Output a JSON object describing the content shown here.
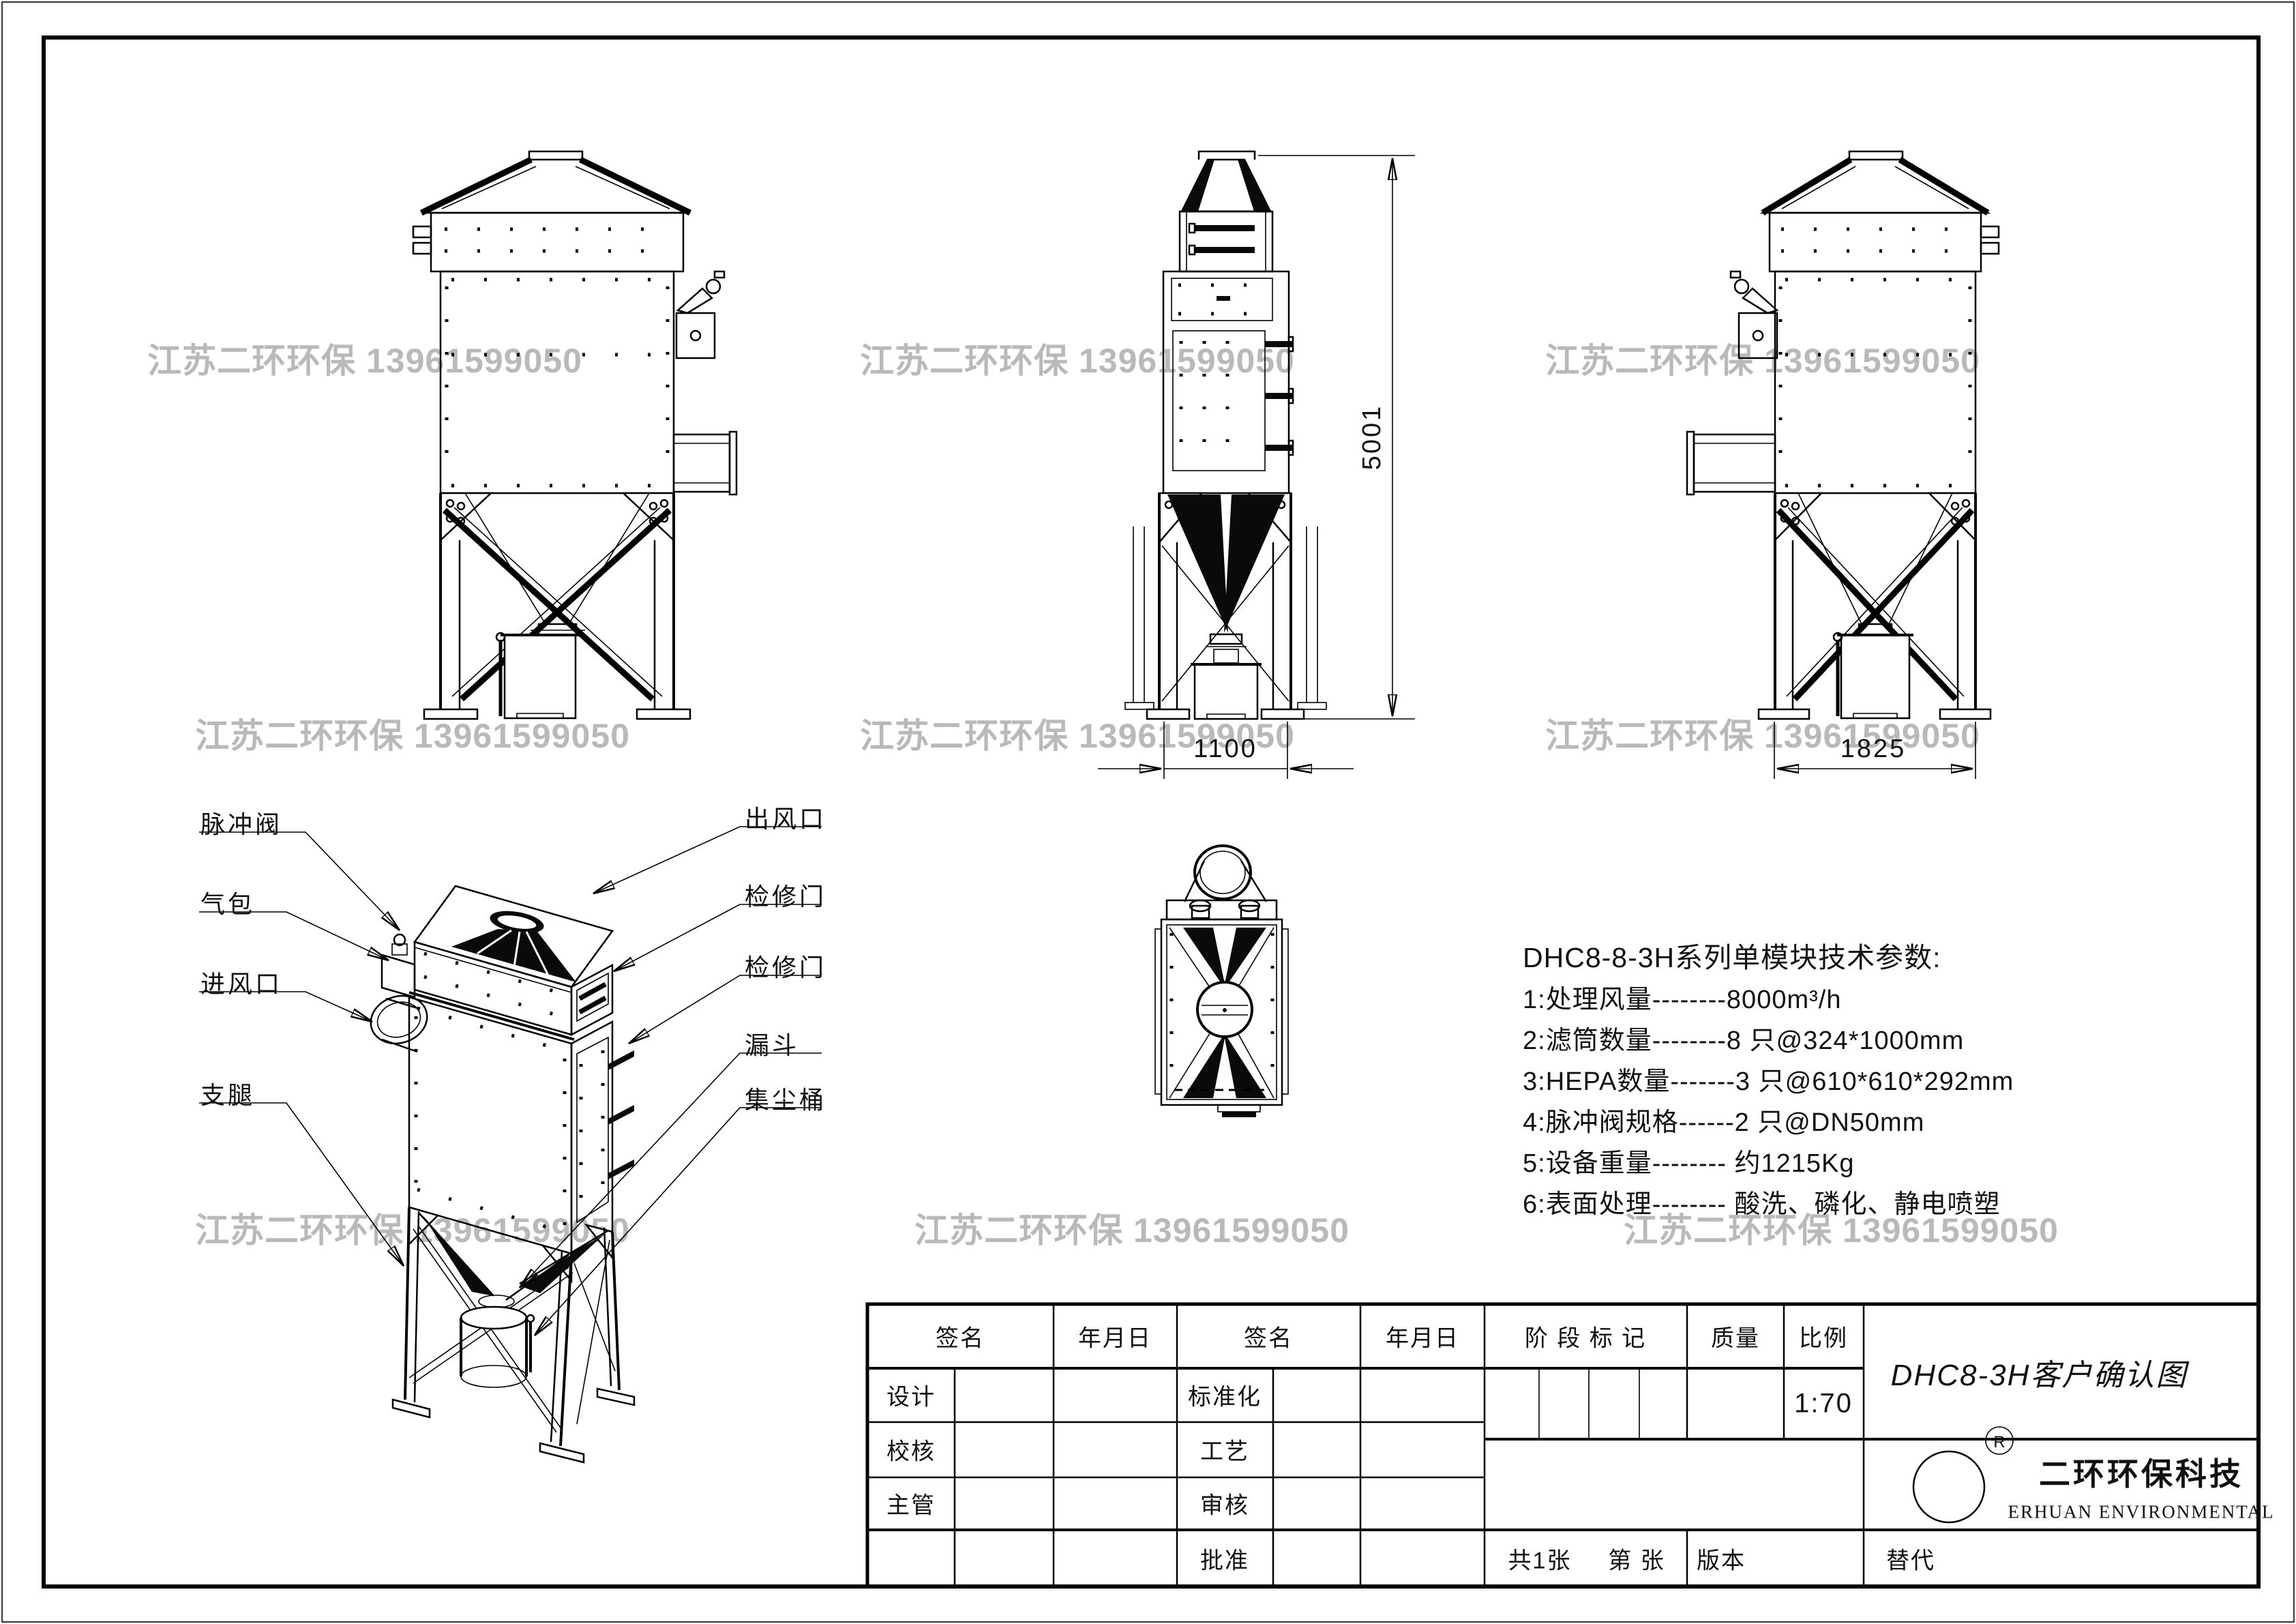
{
  "watermark": {
    "text": "江苏二环环保 13961599050",
    "color": "#b0b0b0"
  },
  "dimensions": {
    "height": "5001",
    "depth": "1100",
    "width": "1825"
  },
  "iso_labels": {
    "left": [
      {
        "text": "脉冲阀"
      },
      {
        "text": "气包"
      },
      {
        "text": "进风口"
      },
      {
        "text": "支腿"
      }
    ],
    "right": [
      {
        "text": "出风口"
      },
      {
        "text": "检修门"
      },
      {
        "text": "检修门"
      },
      {
        "text": "漏斗"
      },
      {
        "text": "集尘桶"
      }
    ]
  },
  "tech_params": {
    "title": "DHC8-8-3H系列单模块技术参数:",
    "items": [
      "1:处理风量--------8000m³/h",
      "2:滤筒数量--------8 只@324*1000mm",
      "3:HEPA数量-------3 只@610*610*292mm",
      "4:脉冲阀规格------2 只@DN50mm",
      "5:设备重量-------- 约1215Kg",
      "6:表面处理-------- 酸洗、磷化、静电喷塑"
    ]
  },
  "title_block": {
    "sign_label": "签名",
    "date_label": "年月日",
    "stage_label": "阶 段 标 记",
    "quality_label": "质量",
    "scale_label": "比例",
    "scale_value": "1:70",
    "roles": {
      "design": "设计",
      "standard": "标准化",
      "check": "校核",
      "process": "工艺",
      "manager": "主管",
      "audit": "审核",
      "approve": "批准"
    },
    "sheet_total": "共1张",
    "sheet_no": "第 张",
    "version_label": "版本",
    "replace_label": "替代",
    "drawing_title": "DHC8-3H客户确认图",
    "company": {
      "logo_text": "JNEH",
      "registered": "®",
      "name": "二环环保科技",
      "name_en": "ERHUAN ENVIRONMENTAL"
    }
  }
}
